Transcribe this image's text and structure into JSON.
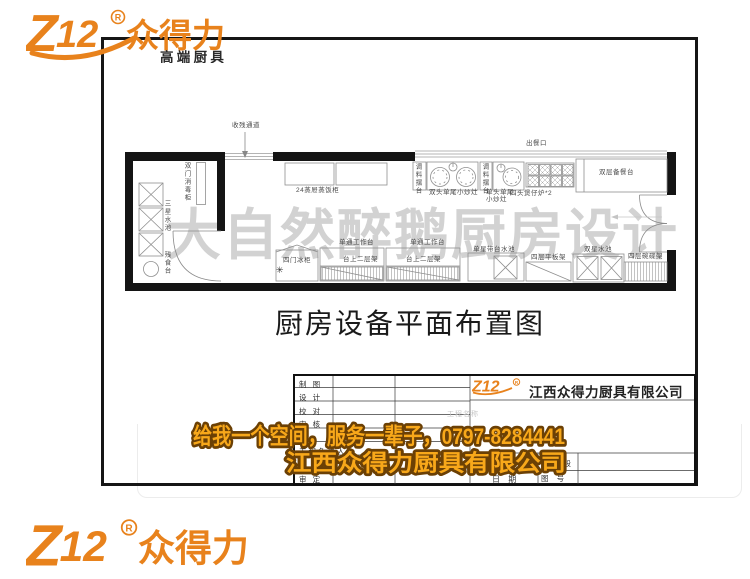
{
  "brand": {
    "logo_text": "Z12",
    "reg_mark": "R",
    "name": "众得力",
    "tagline": "高端厨具",
    "orange": "#e8821c"
  },
  "plan": {
    "watermark": "大自然醉鹅厨房设计",
    "sheet_title": "厨房设备平面布置图",
    "labels": [
      {
        "t": "收残通道",
        "x": 232,
        "y": 122
      },
      {
        "t": "出餐口",
        "x": 526,
        "y": 140
      },
      {
        "t": "24蒸屉蒸饭柜",
        "x": 296,
        "y": 187
      },
      {
        "t": "调料摆台",
        "x": 414,
        "y": 163,
        "v": true
      },
      {
        "t": "双头单尾小炒灶",
        "x": 429,
        "y": 189
      },
      {
        "t": "调料摆台",
        "x": 481,
        "y": 163,
        "v": true
      },
      {
        "t": "单头单尾\n小炒灶",
        "x": 486,
        "y": 189
      },
      {
        "t": "四头煲仔炉*2",
        "x": 510,
        "y": 190
      },
      {
        "t": "双层备餐台",
        "x": 599,
        "y": 169
      },
      {
        "t": "双门消毒柜",
        "x": 183,
        "y": 162,
        "v": true
      },
      {
        "t": "三星水池",
        "x": 163,
        "y": 200,
        "v": true
      },
      {
        "t": "残食台",
        "x": 163,
        "y": 251,
        "v": true
      },
      {
        "t": "四门冰柜",
        "x": 283,
        "y": 257
      },
      {
        "t": "✳",
        "x": 276,
        "y": 267,
        "snow": true
      },
      {
        "t": "单通工作台",
        "x": 339,
        "y": 239
      },
      {
        "t": "台上二层架",
        "x": 343,
        "y": 256
      },
      {
        "t": "单通工作台",
        "x": 410,
        "y": 239
      },
      {
        "t": "台上二层架",
        "x": 406,
        "y": 256
      },
      {
        "t": "单星带台水池",
        "x": 473,
        "y": 246
      },
      {
        "t": "四层平板架",
        "x": 531,
        "y": 254
      },
      {
        "t": "双星水池",
        "x": 584,
        "y": 246
      },
      {
        "t": "四层碗碟架",
        "x": 628,
        "y": 253
      }
    ]
  },
  "titleblock": {
    "rows": [
      {
        "label": "制 图",
        "y": 379
      },
      {
        "label": "设 计",
        "y": 392
      },
      {
        "label": "校 对",
        "y": 406
      },
      {
        "label": "审 核",
        "y": 419
      },
      {
        "label": "",
        "y": 432
      },
      {
        "label": "工程负责人",
        "y": 446
      },
      {
        "label": "",
        "y": 459
      },
      {
        "label": "审 定",
        "y": 474
      }
    ],
    "company": "江西众得力厨具有限公司",
    "project_label": "工程名称",
    "date_label": "日 期",
    "stage_label": "设计阶段",
    "number_label": "图 号"
  },
  "banner": {
    "line1": "给我一个空间，服务一辈子，0797-8284441",
    "line2": "江西众得力厨具有限公司",
    "fill": "#f8a81a",
    "stroke": "#6b4005"
  }
}
